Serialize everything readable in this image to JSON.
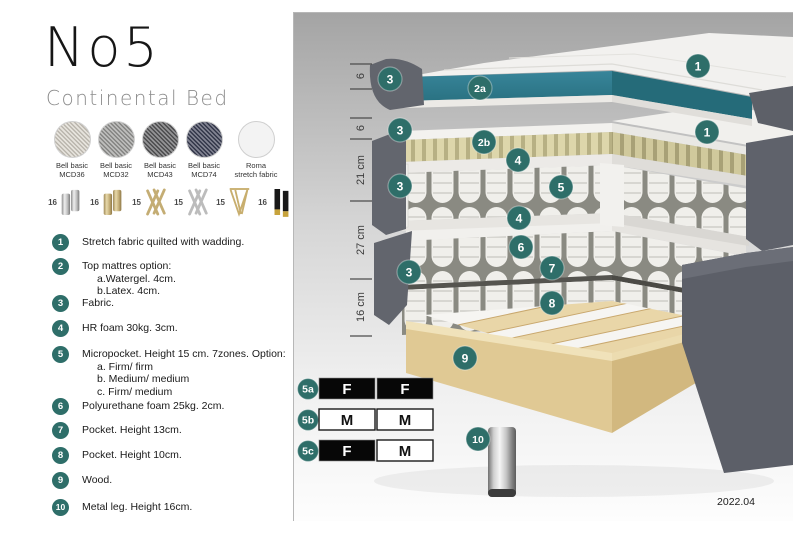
{
  "title": "No5",
  "subtitle": "Continental Bed",
  "fabrics": [
    {
      "name": "Bell basic",
      "code": "MCD36",
      "color": "#d9d4ca"
    },
    {
      "name": "Bell basic",
      "code": "MCD32",
      "color": "#9a9a98"
    },
    {
      "name": "Bell basic",
      "code": "MCD43",
      "color": "#58585a"
    },
    {
      "name": "Bell basic",
      "code": "MCD74",
      "color": "#3b3f55"
    },
    {
      "name": "Roma",
      "code": "stretch fabric",
      "color": "#f3f3f3"
    }
  ],
  "legs": [
    {
      "height": "16",
      "type": "cylinder-silver"
    },
    {
      "height": "16",
      "type": "cylinder-gold"
    },
    {
      "height": "15",
      "type": "cross-gold"
    },
    {
      "height": "15",
      "type": "cross-silver"
    },
    {
      "height": "15",
      "type": "hairpin-gold"
    },
    {
      "height": "16",
      "type": "tapered-black-gold"
    }
  ],
  "spec_items": [
    {
      "num": "1",
      "text": "Stretch fabric quilted with wadding."
    },
    {
      "num": "2",
      "text": "Top mattres option:",
      "options": [
        "a.Watergel. 4cm.",
        "b.Latex. 4cm."
      ]
    },
    {
      "num": "3",
      "text": "Fabric."
    },
    {
      "num": "4",
      "text": "HR foam 30kg. 3cm."
    },
    {
      "num": "5",
      "text": "Micropocket. Height 15 cm. 7zones. Option:",
      "options": [
        "a. Firm/ firm",
        "b. Medium/ medium",
        "c. Firm/ medium"
      ]
    },
    {
      "num": "6",
      "text": "Polyurethane foam 25kg. 2cm."
    },
    {
      "num": "7",
      "text": "Pocket. Height 13cm."
    },
    {
      "num": "8",
      "text": "Pocket. Height 10cm."
    },
    {
      "num": "9",
      "text": "Wood."
    },
    {
      "num": "10",
      "text": "Metal leg. Height 16cm."
    }
  ],
  "diagram": {
    "dimensions": [
      "6",
      "6",
      "21 cm",
      "27 cm",
      "16 cm"
    ],
    "callouts": [
      "3",
      "2a",
      "1",
      "3",
      "2b",
      "1",
      "4",
      "5",
      "3",
      "4",
      "6",
      "7",
      "3",
      "8",
      "9",
      "10"
    ],
    "firmness_rows": [
      {
        "label": "5a",
        "cells": [
          {
            "text": "F",
            "variant": "dark"
          },
          {
            "text": "F",
            "variant": "dark"
          }
        ]
      },
      {
        "label": "5b",
        "cells": [
          {
            "text": "M",
            "variant": "light"
          },
          {
            "text": "M",
            "variant": "light"
          }
        ]
      },
      {
        "label": "5c",
        "cells": [
          {
            "text": "F",
            "variant": "dark"
          },
          {
            "text": "M",
            "variant": "light"
          }
        ]
      }
    ],
    "version": "2022.04",
    "badge_color": "#2e6e69",
    "gel_color": "#2f808d",
    "latex_color": "#d9d2a6",
    "fabric_side_color": "#63666e",
    "wood_color": "#e6d2a2"
  }
}
